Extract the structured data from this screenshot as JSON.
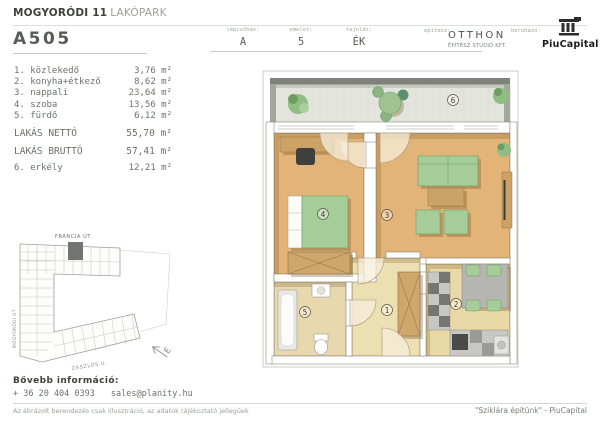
{
  "header": {
    "project": {
      "bold": "MOGYORÓDI 11",
      "light": "LAKÓPARK"
    },
    "unit_id": "A505",
    "meta": [
      {
        "label": "lépcsőház:",
        "value": "A"
      },
      {
        "label": "emelet:",
        "value": "5"
      },
      {
        "label": "tájolás:",
        "value": "ÉK"
      }
    ],
    "architect": {
      "label": "építész:",
      "name": "OTTHON",
      "subtitle": "ÉPÍTÉSZ STÚDIÓ KFT."
    },
    "developer": {
      "label": "beruházó:",
      "name": "PiuCapital"
    }
  },
  "room_list": {
    "rooms": [
      {
        "label": "1. közlekedő",
        "area": "3,76 m²"
      },
      {
        "label": "2. konyha+étkező",
        "area": "8,62 m²"
      },
      {
        "label": "3. nappali",
        "area": "23,64 m²"
      },
      {
        "label": "4. szoba",
        "area": "13,56 m²"
      },
      {
        "label": "5. fürdő",
        "area": "6,12 m²"
      }
    ],
    "net": {
      "label": "LAKÁS NETTÓ",
      "area": "55,70 m²"
    },
    "gross": {
      "label": "LAKÁS BRUTTÓ",
      "area": "57,41 m²"
    },
    "balcony": {
      "label": "6. erkély",
      "area": "12,21 m²"
    }
  },
  "site_plan": {
    "street_top": "FRANCIA ÚT",
    "street_left": "MOGYORÓDI ÚT",
    "street_bottom": "ZÁSZLÓS U.",
    "north_letter": "É"
  },
  "floor_plan": {
    "room_labels": [
      "1",
      "2",
      "3",
      "4",
      "5",
      "6"
    ]
  },
  "footer": {
    "info_title": "Bővebb információ:",
    "phone": "+ 36 20 404 0393",
    "email": "sales@planity.hu",
    "disclaimer": "Az ábrázolt berendezés csak illusztráció, az adatok tájékoztató jellegűek",
    "slogan": "\"Sziklára építünk\" - PiuCapital"
  },
  "colors": {
    "wood_floor": "#e2b478",
    "tile_floor": "#e9dcab",
    "balcony_floor": "#e3e4dc",
    "furniture_green": "#a5cc99",
    "furniture_tan": "#cda266",
    "site_highlight": "#70756f"
  }
}
